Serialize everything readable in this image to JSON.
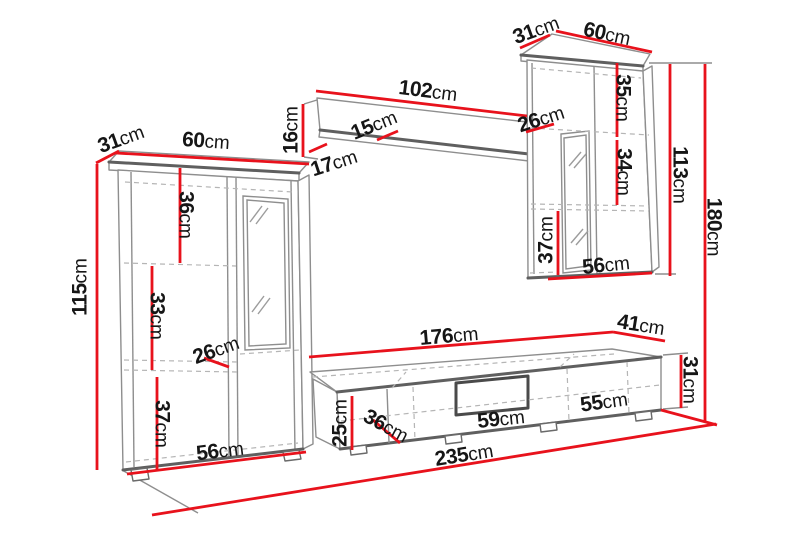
{
  "unit": "cm",
  "colors": {
    "dimension_red": "#e8121c",
    "outline_gray": "#8e8e8e",
    "outline_dark": "#5f5f5f",
    "hidden_line_gray": "#b5b5b5",
    "label_text": "#161616",
    "background": "#ffffff"
  },
  "labels": [
    {
      "id": "left-cabinet-depth",
      "value": "31",
      "unit": "cm"
    },
    {
      "id": "left-cabinet-width",
      "value": "60",
      "unit": "cm"
    },
    {
      "id": "left-cabinet-height",
      "value": "115",
      "unit": "cm"
    },
    {
      "id": "left-cabinet-top-section-height",
      "value": "36",
      "unit": "cm"
    },
    {
      "id": "left-cabinet-middle-section-height",
      "value": "33",
      "unit": "cm"
    },
    {
      "id": "left-cabinet-shelf-depth",
      "value": "26",
      "unit": "cm"
    },
    {
      "id": "left-cabinet-bottom-section-height",
      "value": "37",
      "unit": "cm"
    },
    {
      "id": "left-cabinet-base-width",
      "value": "56",
      "unit": "cm"
    },
    {
      "id": "wall-shelf-length",
      "value": "102",
      "unit": "cm"
    },
    {
      "id": "wall-shelf-height",
      "value": "16",
      "unit": "cm"
    },
    {
      "id": "wall-shelf-depth",
      "value": "15",
      "unit": "cm"
    },
    {
      "id": "wall-shelf-bottom-depth",
      "value": "17",
      "unit": "cm"
    },
    {
      "id": "right-cabinet-depth",
      "value": "31",
      "unit": "cm"
    },
    {
      "id": "right-cabinet-width",
      "value": "60",
      "unit": "cm"
    },
    {
      "id": "right-cabinet-top-section-height",
      "value": "35",
      "unit": "cm"
    },
    {
      "id": "right-cabinet-shelf-depth",
      "value": "26",
      "unit": "cm"
    },
    {
      "id": "right-cabinet-middle-section-height",
      "value": "34",
      "unit": "cm"
    },
    {
      "id": "right-cabinet-bottom-section-height",
      "value": "37",
      "unit": "cm"
    },
    {
      "id": "right-cabinet-base-width",
      "value": "56",
      "unit": "cm"
    },
    {
      "id": "right-cabinet-height",
      "value": "113",
      "unit": "cm"
    },
    {
      "id": "wall-unit-total-height",
      "value": "180",
      "unit": "cm"
    },
    {
      "id": "tv-stand-length",
      "value": "176",
      "unit": "cm"
    },
    {
      "id": "tv-stand-right-section-length",
      "value": "41",
      "unit": "cm"
    },
    {
      "id": "tv-stand-height",
      "value": "31",
      "unit": "cm"
    },
    {
      "id": "tv-stand-front-height",
      "value": "25",
      "unit": "cm"
    },
    {
      "id": "tv-stand-depth",
      "value": "36",
      "unit": "cm"
    },
    {
      "id": "tv-stand-niche-width",
      "value": "59",
      "unit": "cm"
    },
    {
      "id": "tv-stand-right-door-width",
      "value": "55",
      "unit": "cm"
    },
    {
      "id": "wall-unit-total-width",
      "value": "235",
      "unit": "cm"
    }
  ]
}
